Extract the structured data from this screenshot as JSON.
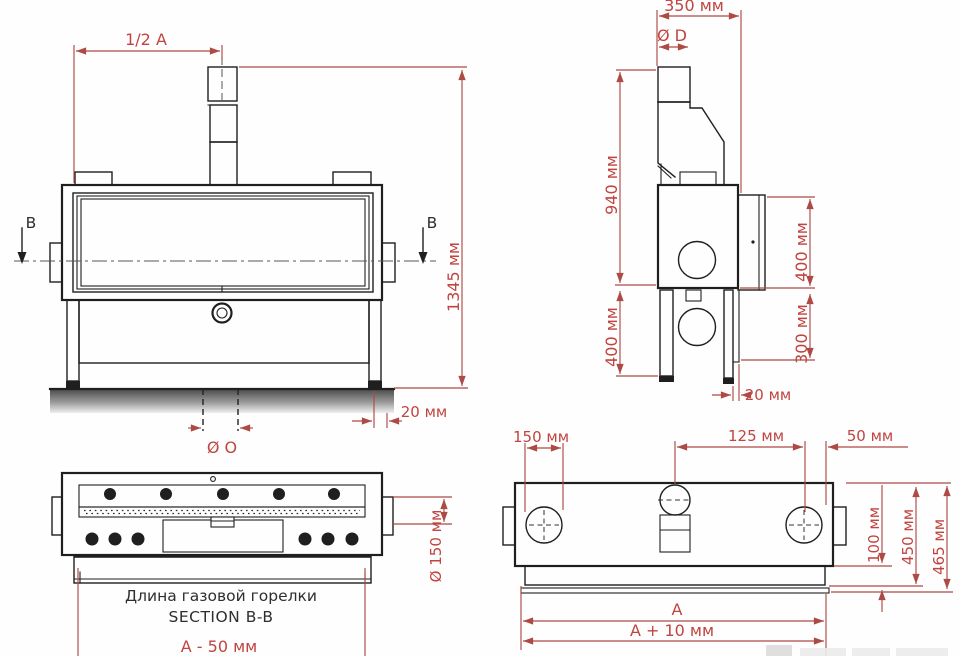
{
  "drawing_type": "furnace technical drawing, four orthographic views",
  "colors": {
    "dimension_line": "#ae4a45",
    "dimension_text": "#c0443f",
    "drawing_line": "#1f1f1f",
    "caption_text": "#2e2e2e",
    "background": "#fefefe"
  },
  "front_view": {
    "dim_half_width": "1/2 A",
    "dim_total_height": "1345 мм",
    "dim_ground_clearance": "20 мм",
    "dim_bottom_opening": "Ø O",
    "section_label_left": "B",
    "section_label_right": "B"
  },
  "side_view": {
    "dim_depth": "350 мм",
    "dim_flue_diameter": "Ø D",
    "dim_upper_height": "940 мм",
    "dim_leg_height": "400 мм",
    "dim_door_height": "400 мм",
    "dim_lower_height": "300 мм",
    "dim_leg_offset": "20 мм"
  },
  "section_view": {
    "caption_line1": "Длина газовой горелки",
    "caption_line2": "SECTION B-B",
    "dim_burner_diameter": "Ø 150 мм",
    "dim_burner_length": "A - 50 мм"
  },
  "top_view": {
    "dim_side_opening": "150 мм",
    "dim_opening_offset": "125 мм",
    "dim_flue_offset": "50 мм",
    "dim_base_height": "100 мм",
    "dim_depth_inner": "450 мм",
    "dim_depth_outer": "465 мм",
    "dim_length_a": "A",
    "dim_length_total": "A + 10 мм"
  }
}
